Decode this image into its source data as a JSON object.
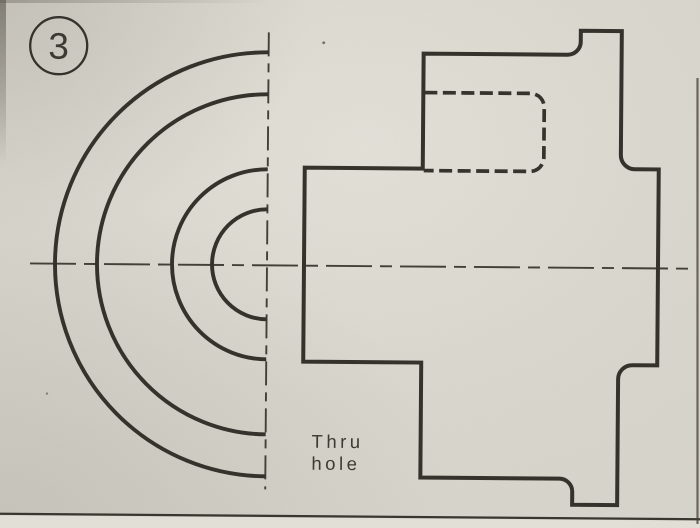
{
  "drawing": {
    "balloon": {
      "number": "3"
    },
    "label": {
      "line1": "Thru",
      "line2": "hole"
    },
    "colors": {
      "paper": "#d8d5cc",
      "paper_below_border": "#e4e1d8",
      "outline": "#33302a",
      "hidden_line": "#34312b",
      "centerline": "#413e36",
      "border": "#37342d",
      "text": "#3b3831"
    }
  }
}
